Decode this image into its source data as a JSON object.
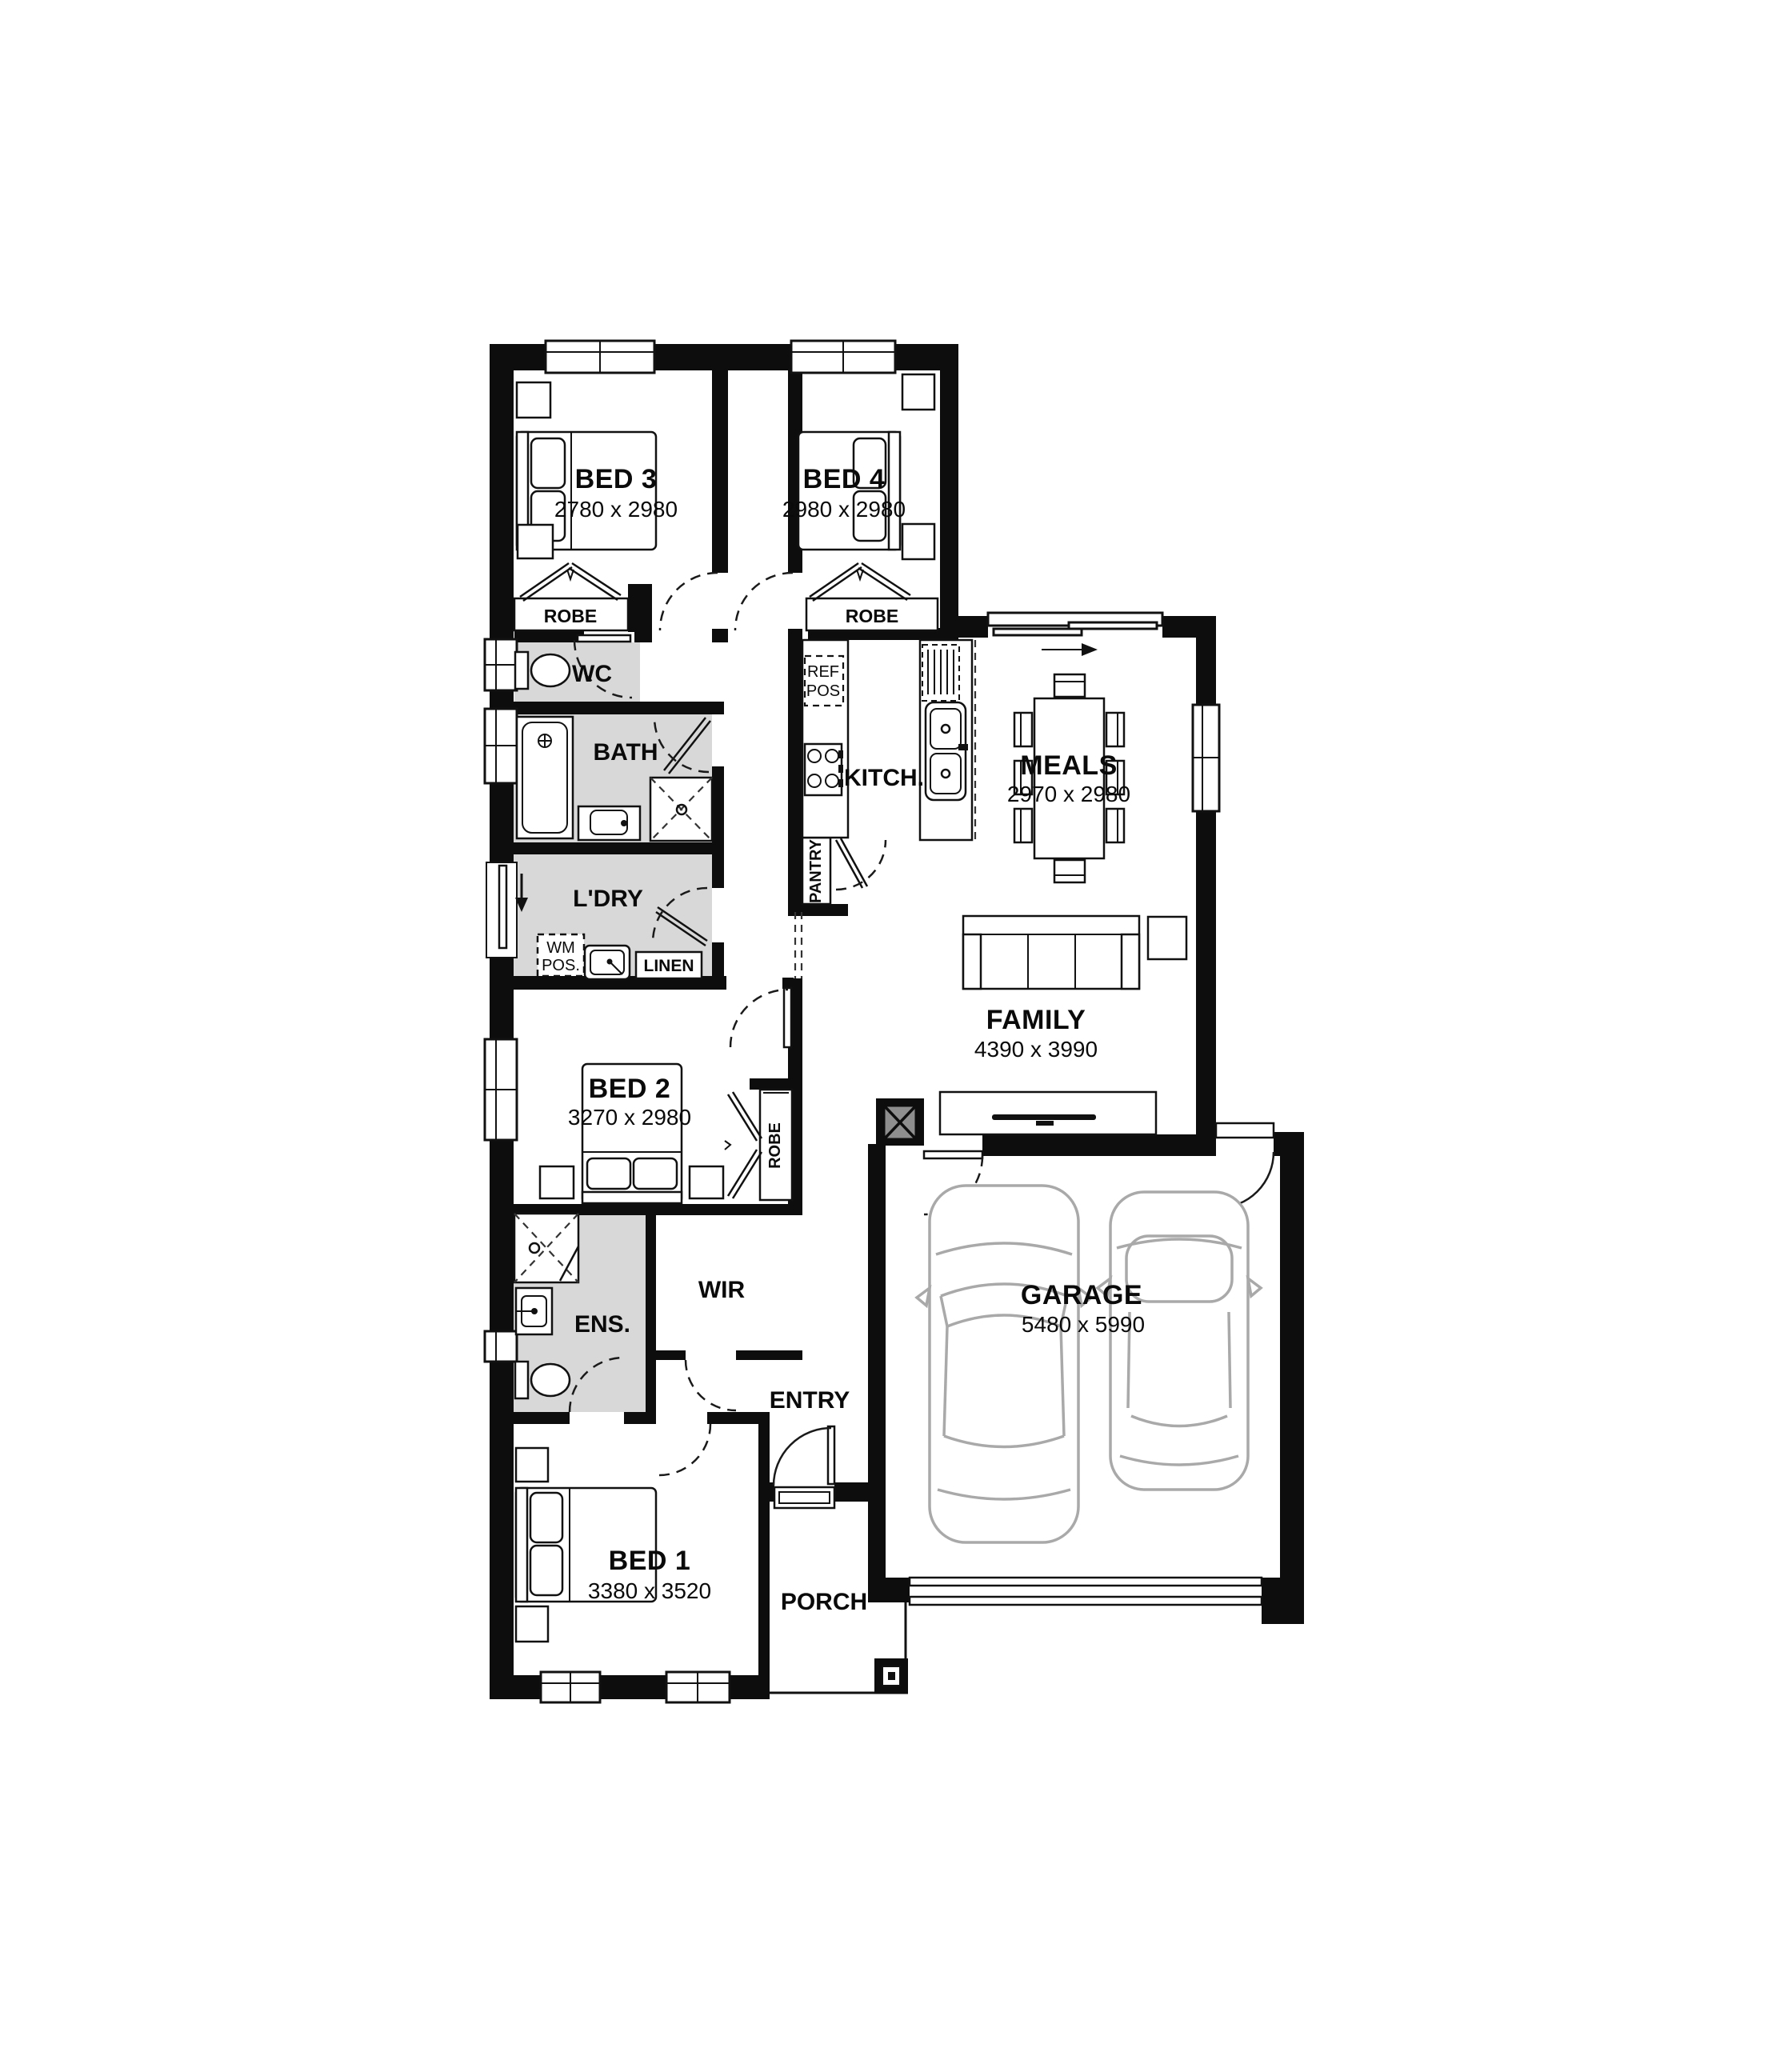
{
  "plan": {
    "bed3": {
      "name": "BED 3",
      "dims": "2780 x 2980"
    },
    "bed4": {
      "name": "BED 4",
      "dims": "2980 x 2980"
    },
    "bed2": {
      "name": "BED 2",
      "dims": "3270 x 2980"
    },
    "bed1": {
      "name": "BED 1",
      "dims": "3380 x 3520"
    },
    "meals": {
      "name": "MEALS",
      "dims": "2970 x 2980"
    },
    "family": {
      "name": "FAMILY",
      "dims": "4390 x 3990"
    },
    "garage": {
      "name": "GARAGE",
      "dims": "5480 x 5990"
    },
    "wc": "WC",
    "bath": "BATH",
    "ldry": "L'DRY",
    "ens": "ENS.",
    "wir": "WIR",
    "kitch": "KITCH.",
    "entry": "ENTRY",
    "porch": "PORCH",
    "robe": "ROBE",
    "linen": "LINEN",
    "pantry": "PANTRY",
    "ref_pos_1": "REF",
    "ref_pos_2": "POS",
    "wm_pos_1": "WM",
    "wm_pos_2": "POS."
  },
  "colors": {
    "wall": "#0d0d0d",
    "wet_area": "#d8d8d8",
    "post": "#8e8e8e",
    "car": "#a9a9a9"
  }
}
